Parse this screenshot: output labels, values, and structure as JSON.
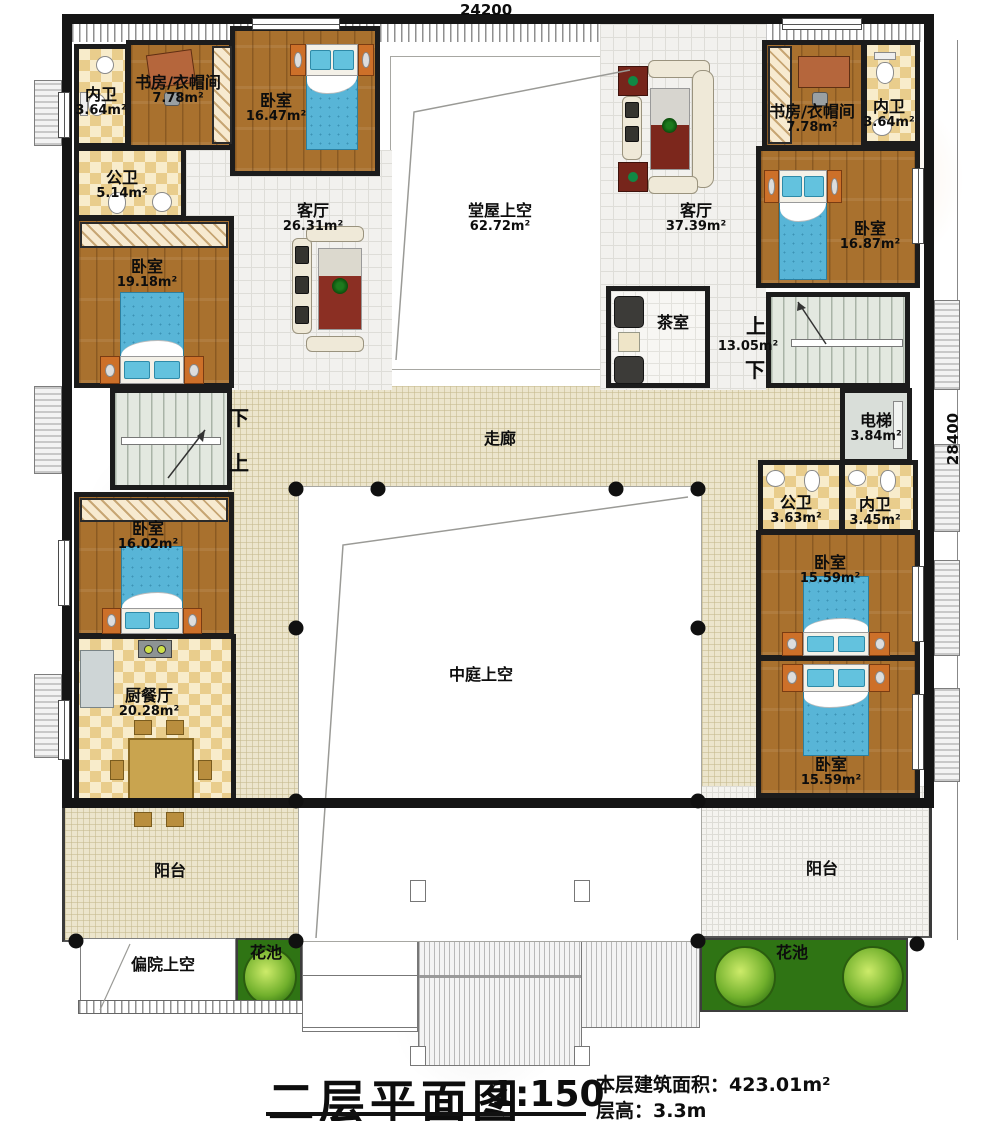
{
  "dimensions": {
    "top": "24200",
    "right": "28400"
  },
  "title": {
    "name": "二层平面图",
    "scale": "1:150",
    "info_area": "本层建筑面积：423.01m²",
    "info_height": "层高：3.3m"
  },
  "stairs": {
    "left": {
      "down": "下",
      "up": "上"
    },
    "right": {
      "up": "上",
      "area": "13.05m²",
      "down": "下"
    }
  },
  "rooms": {
    "neiwei_tl": {
      "name": "内卫",
      "area": "3.64m²"
    },
    "shufang_tl": {
      "name": "书房/衣帽间",
      "area": "7.78m²"
    },
    "woshi_1647": {
      "name": "卧室",
      "area": "16.47m²"
    },
    "gongwei_514": {
      "name": "公卫",
      "area": "5.14m²"
    },
    "keting_2631": {
      "name": "客厅",
      "area": "26.31m²"
    },
    "woshi_1918": {
      "name": "卧室",
      "area": "19.18m²"
    },
    "tangwu": {
      "name": "堂屋上空",
      "area": "62.72m²"
    },
    "keting_3739": {
      "name": "客厅",
      "area": "37.39m²"
    },
    "shufang_tr": {
      "name": "书房/衣帽间",
      "area": "7.78m²"
    },
    "neiwei_tr": {
      "name": "内卫",
      "area": "3.64m²"
    },
    "woshi_1687": {
      "name": "卧室",
      "area": "16.87m²"
    },
    "chashi": {
      "name": "茶室"
    },
    "dianti": {
      "name": "电梯",
      "area": "3.84m²"
    },
    "zoulang": {
      "name": "走廊"
    },
    "gongwei_363": {
      "name": "公卫",
      "area": "3.63m²"
    },
    "neiwei_345": {
      "name": "内卫",
      "area": "3.45m²"
    },
    "woshi_1559a": {
      "name": "卧室",
      "area": "15.59m²"
    },
    "woshi_1559b": {
      "name": "卧室",
      "area": "15.59m²"
    },
    "woshi_1602": {
      "name": "卧室",
      "area": "16.02m²"
    },
    "chucanting": {
      "name": "厨餐厅",
      "area": "20.28m²"
    },
    "zhongting": {
      "name": "中庭上空"
    },
    "yangtai_l": {
      "name": "阳台"
    },
    "yangtai_r": {
      "name": "阳台"
    },
    "huachi_l": {
      "name": "花池"
    },
    "huachi_r": {
      "name": "花池"
    },
    "pianyuan": {
      "name": "偏院上空"
    }
  }
}
